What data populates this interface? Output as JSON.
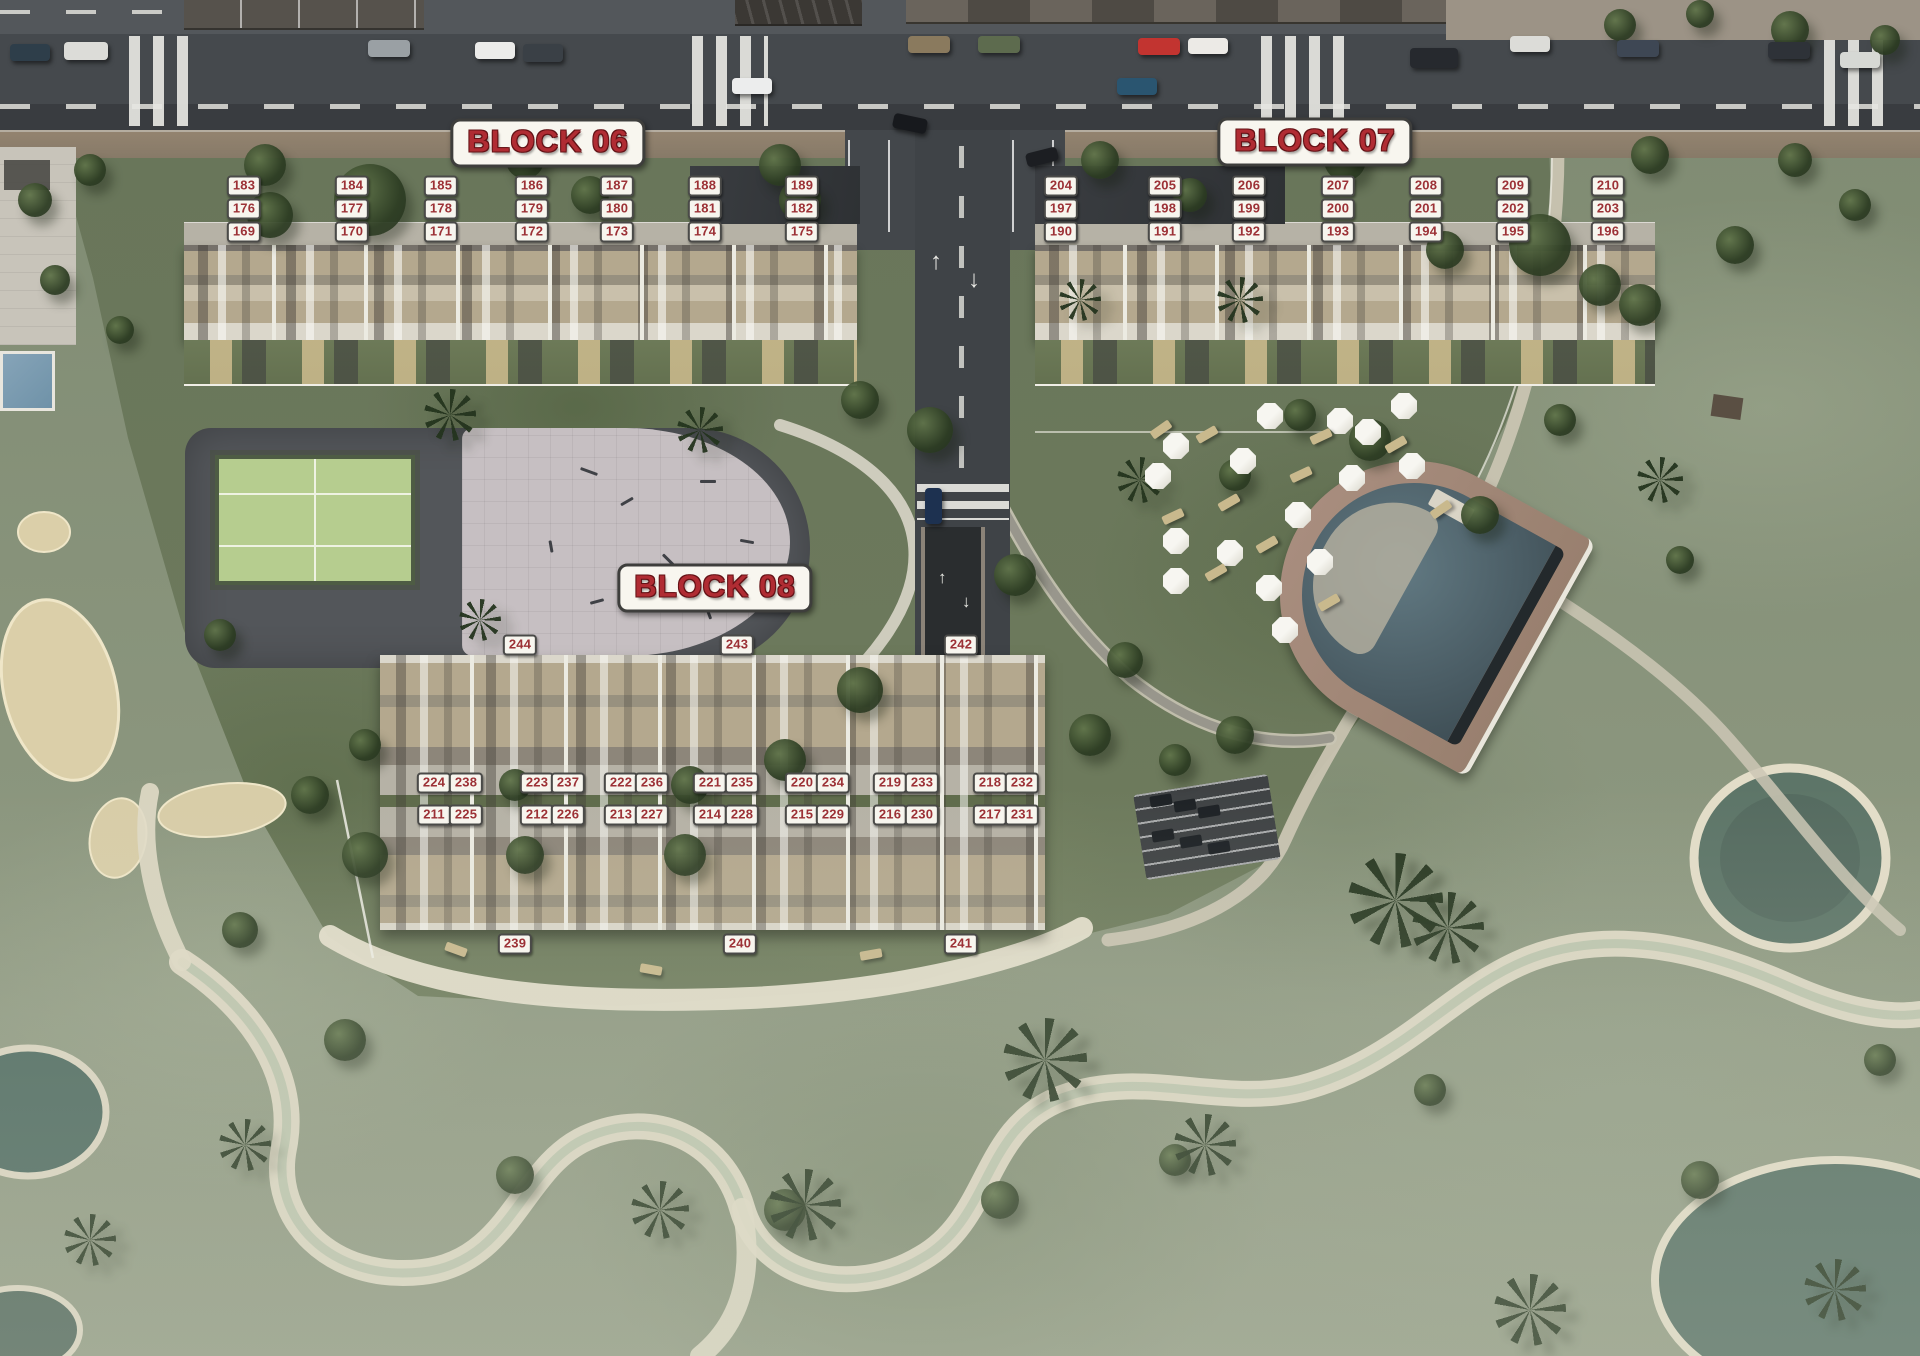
{
  "plan": {
    "type": "resort-site-plan-aerial",
    "colors": {
      "label_text_red": "#9c3136",
      "title_red": "#b02c33",
      "plate_white": "#f7f5ee"
    }
  },
  "blocks": [
    {
      "id": "block-06",
      "title": "BLOCK 06",
      "cx": 548,
      "cy": 143
    },
    {
      "id": "block-07",
      "title": "BLOCK 07",
      "cx": 1315,
      "cy": 142
    },
    {
      "id": "block-08",
      "title": "BLOCK 08",
      "cx": 715,
      "cy": 588
    }
  ],
  "road": {
    "arrow_up": "↑",
    "arrow_down": "↓"
  },
  "unit_labels": [
    {
      "n": "183",
      "x": 244,
      "y": 186
    },
    {
      "n": "184",
      "x": 352,
      "y": 186
    },
    {
      "n": "185",
      "x": 441,
      "y": 186
    },
    {
      "n": "186",
      "x": 532,
      "y": 186
    },
    {
      "n": "187",
      "x": 617,
      "y": 186
    },
    {
      "n": "188",
      "x": 705,
      "y": 186
    },
    {
      "n": "189",
      "x": 802,
      "y": 186
    },
    {
      "n": "176",
      "x": 244,
      "y": 209
    },
    {
      "n": "177",
      "x": 352,
      "y": 209
    },
    {
      "n": "178",
      "x": 441,
      "y": 209
    },
    {
      "n": "179",
      "x": 532,
      "y": 209
    },
    {
      "n": "180",
      "x": 617,
      "y": 209
    },
    {
      "n": "181",
      "x": 705,
      "y": 209
    },
    {
      "n": "182",
      "x": 802,
      "y": 209
    },
    {
      "n": "169",
      "x": 244,
      "y": 232
    },
    {
      "n": "170",
      "x": 352,
      "y": 232
    },
    {
      "n": "171",
      "x": 441,
      "y": 232
    },
    {
      "n": "172",
      "x": 532,
      "y": 232
    },
    {
      "n": "173",
      "x": 617,
      "y": 232
    },
    {
      "n": "174",
      "x": 705,
      "y": 232
    },
    {
      "n": "175",
      "x": 802,
      "y": 232
    },
    {
      "n": "204",
      "x": 1061,
      "y": 186
    },
    {
      "n": "205",
      "x": 1165,
      "y": 186
    },
    {
      "n": "206",
      "x": 1249,
      "y": 186
    },
    {
      "n": "207",
      "x": 1338,
      "y": 186
    },
    {
      "n": "208",
      "x": 1426,
      "y": 186
    },
    {
      "n": "209",
      "x": 1513,
      "y": 186
    },
    {
      "n": "210",
      "x": 1608,
      "y": 186
    },
    {
      "n": "197",
      "x": 1061,
      "y": 209
    },
    {
      "n": "198",
      "x": 1165,
      "y": 209
    },
    {
      "n": "199",
      "x": 1249,
      "y": 209
    },
    {
      "n": "200",
      "x": 1338,
      "y": 209
    },
    {
      "n": "201",
      "x": 1426,
      "y": 209
    },
    {
      "n": "202",
      "x": 1513,
      "y": 209
    },
    {
      "n": "203",
      "x": 1608,
      "y": 209
    },
    {
      "n": "190",
      "x": 1061,
      "y": 232
    },
    {
      "n": "191",
      "x": 1165,
      "y": 232
    },
    {
      "n": "192",
      "x": 1249,
      "y": 232
    },
    {
      "n": "193",
      "x": 1338,
      "y": 232
    },
    {
      "n": "194",
      "x": 1426,
      "y": 232
    },
    {
      "n": "195",
      "x": 1513,
      "y": 232
    },
    {
      "n": "196",
      "x": 1608,
      "y": 232
    },
    {
      "n": "244",
      "x": 520,
      "y": 645
    },
    {
      "n": "243",
      "x": 737,
      "y": 645
    },
    {
      "n": "242",
      "x": 961,
      "y": 645
    },
    {
      "n": "224",
      "x": 434,
      "y": 783
    },
    {
      "n": "238",
      "x": 466,
      "y": 783
    },
    {
      "n": "223",
      "x": 537,
      "y": 783
    },
    {
      "n": "237",
      "x": 568,
      "y": 783
    },
    {
      "n": "222",
      "x": 621,
      "y": 783
    },
    {
      "n": "236",
      "x": 652,
      "y": 783
    },
    {
      "n": "221",
      "x": 710,
      "y": 783
    },
    {
      "n": "235",
      "x": 742,
      "y": 783
    },
    {
      "n": "220",
      "x": 802,
      "y": 783
    },
    {
      "n": "234",
      "x": 833,
      "y": 783
    },
    {
      "n": "219",
      "x": 890,
      "y": 783
    },
    {
      "n": "233",
      "x": 922,
      "y": 783
    },
    {
      "n": "218",
      "x": 990,
      "y": 783
    },
    {
      "n": "232",
      "x": 1022,
      "y": 783
    },
    {
      "n": "211",
      "x": 434,
      "y": 815
    },
    {
      "n": "225",
      "x": 466,
      "y": 815
    },
    {
      "n": "212",
      "x": 537,
      "y": 815
    },
    {
      "n": "226",
      "x": 568,
      "y": 815
    },
    {
      "n": "213",
      "x": 621,
      "y": 815
    },
    {
      "n": "227",
      "x": 652,
      "y": 815
    },
    {
      "n": "214",
      "x": 710,
      "y": 815
    },
    {
      "n": "228",
      "x": 742,
      "y": 815
    },
    {
      "n": "215",
      "x": 802,
      "y": 815
    },
    {
      "n": "229",
      "x": 833,
      "y": 815
    },
    {
      "n": "216",
      "x": 890,
      "y": 815
    },
    {
      "n": "230",
      "x": 922,
      "y": 815
    },
    {
      "n": "217",
      "x": 990,
      "y": 815
    },
    {
      "n": "231",
      "x": 1022,
      "y": 815
    },
    {
      "n": "239",
      "x": 515,
      "y": 944
    },
    {
      "n": "240",
      "x": 740,
      "y": 944
    },
    {
      "n": "241",
      "x": 961,
      "y": 944
    }
  ]
}
